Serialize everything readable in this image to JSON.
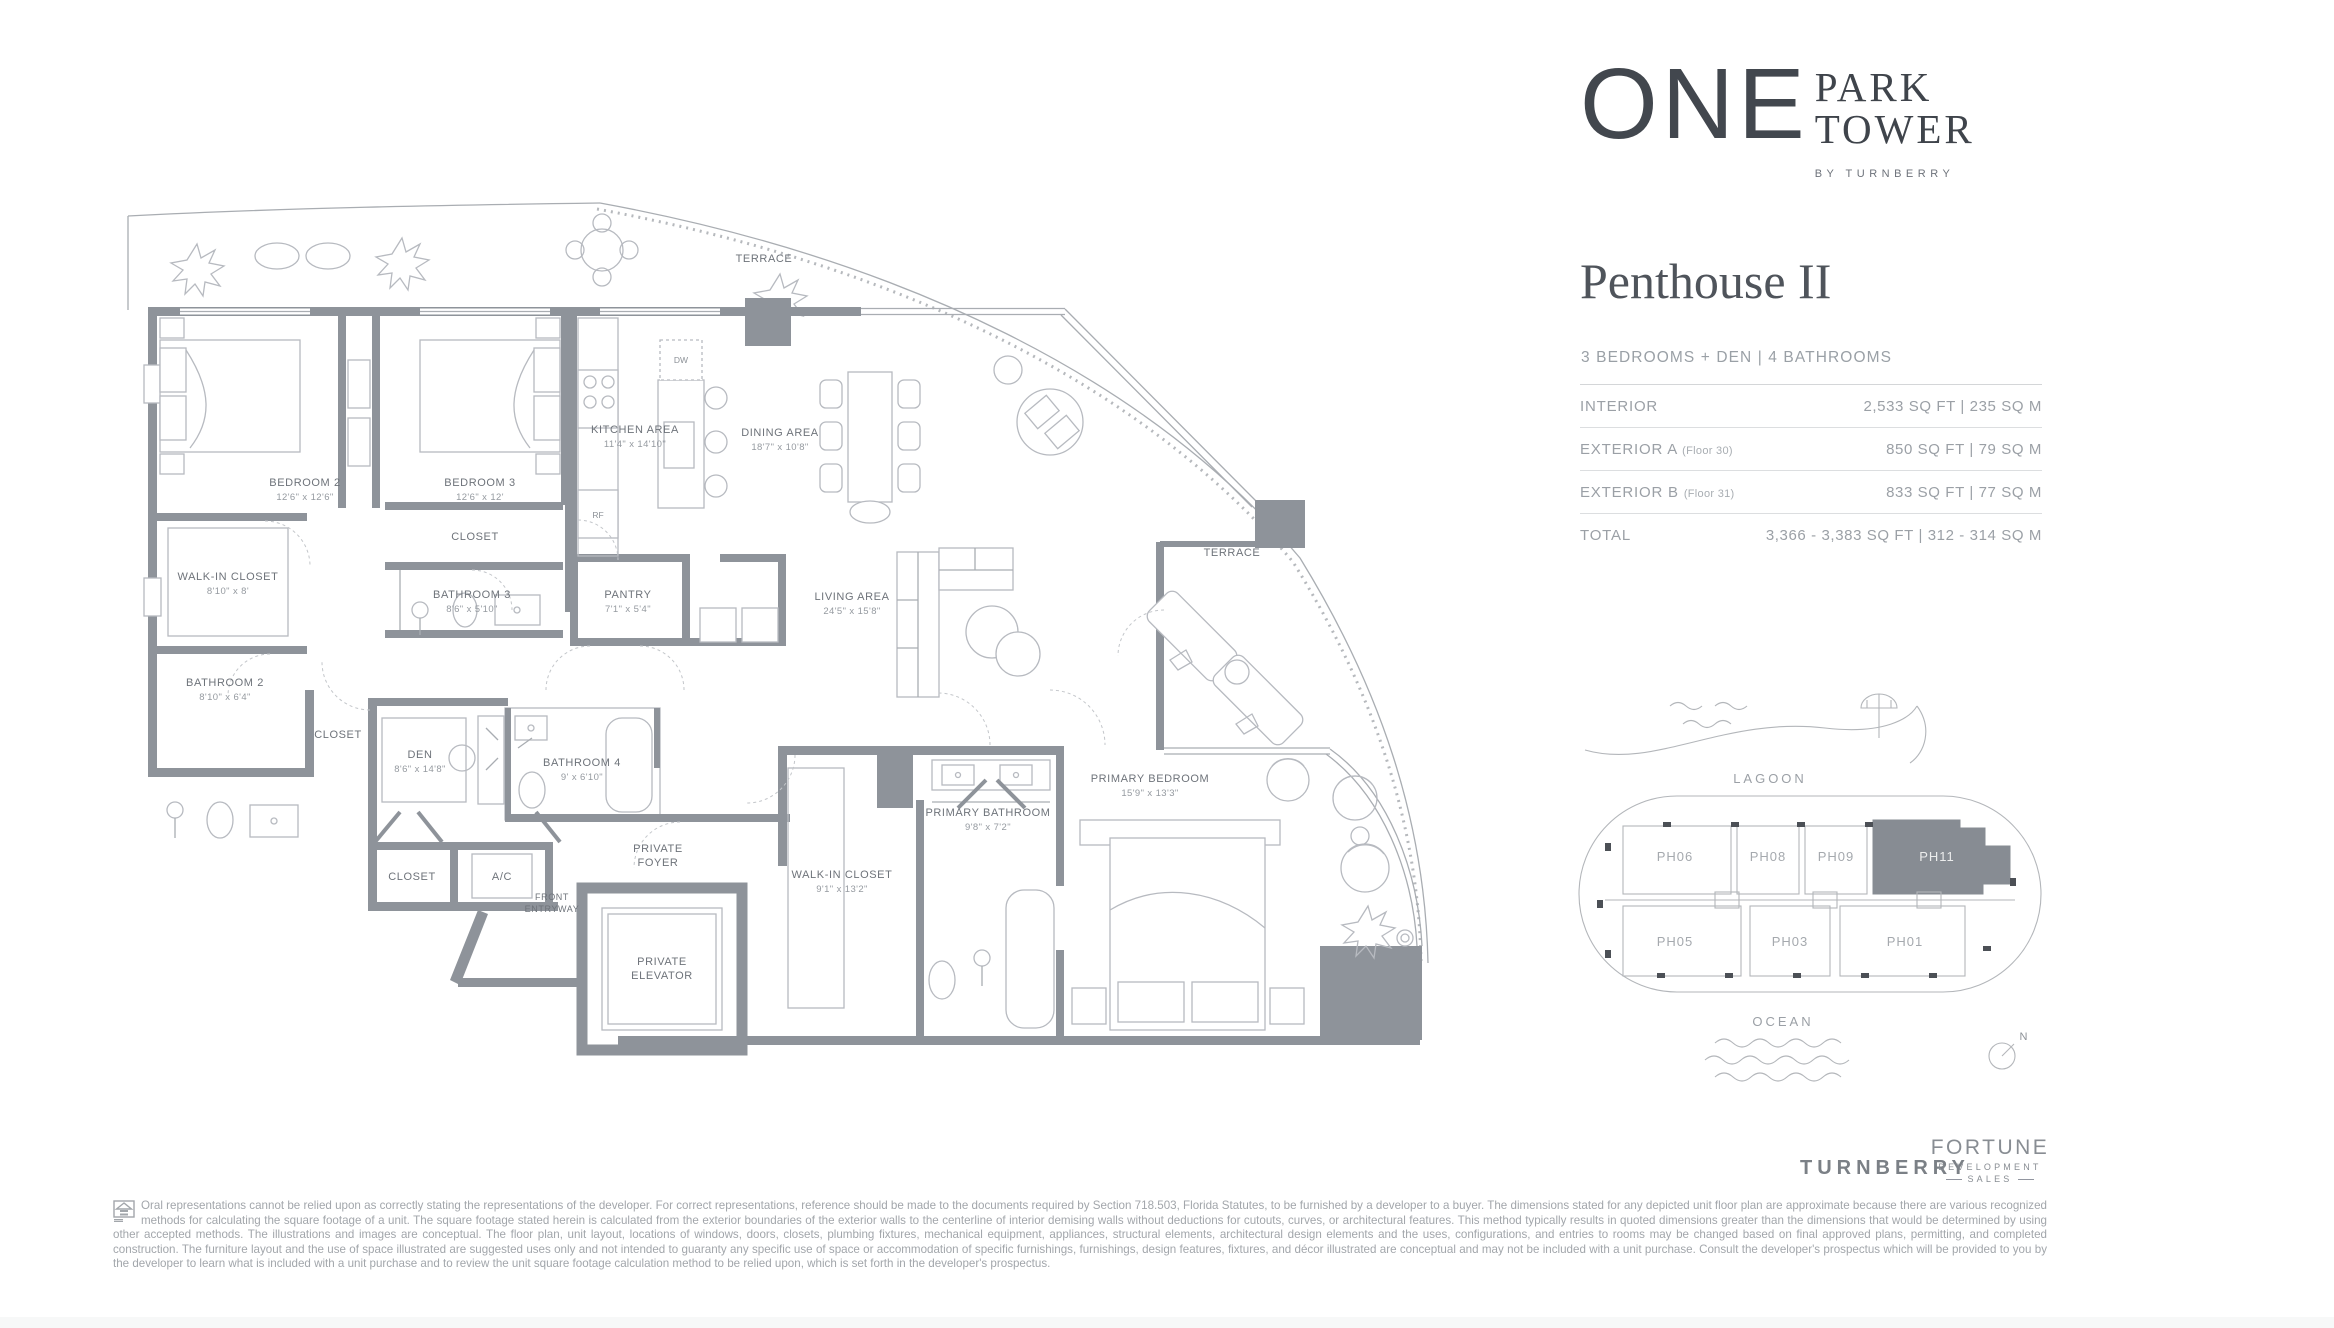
{
  "logo": {
    "one": "ONE",
    "park": "PARK",
    "tower": "TOWER",
    "byline": "BY TURNBERRY"
  },
  "unit": {
    "title": "Penthouse II",
    "subtitle": "3 BEDROOMS + DEN | 4 BATHROOMS",
    "specs": [
      {
        "label": "INTERIOR",
        "note": "",
        "value": "2,533 SQ FT  |  235 SQ M"
      },
      {
        "label": "EXTERIOR A",
        "note": "(Floor 30)",
        "value": "850 SQ FT  |  79 SQ M"
      },
      {
        "label": "EXTERIOR B",
        "note": "(Floor 31)",
        "value": "833 SQ FT  |  77 SQ M"
      },
      {
        "label": "TOTAL",
        "note": "",
        "value": "3,366 - 3,383 SQ FT  |  312 - 314 SQ M"
      }
    ]
  },
  "keyplan": {
    "lagoon": "LAGOON",
    "ocean": "OCEAN",
    "north": "N",
    "units": [
      "PH06",
      "PH08",
      "PH09",
      "PH11",
      "PH05",
      "PH03",
      "PH01"
    ],
    "highlighted": "PH11",
    "highlight_color": "#878c93"
  },
  "brands": {
    "turnberry": "TURNBERRY",
    "fortune_line1": "FORTUNE",
    "fortune_line2": "DEVELOPMENT",
    "fortune_line3": "SALES"
  },
  "disclaimer": {
    "text": "Oral representations cannot be relied upon as correctly stating the representations of the developer. For correct representations, reference should be made to the documents required by Section 718.503, Florida Statutes, to be furnished by a developer to a buyer. The dimensions stated for any depicted unit floor plan are approximate because there are various recognized methods for calculating the square footage of a unit. The square footage stated herein is calculated from the exterior boundaries of the exterior walls to the centerline of interior demising walls without deductions for cutouts, curves, or architectural features. This method typically results in quoted dimensions greater than the dimensions that would be determined by using other accepted methods. The illustrations and images are conceptual. The floor plan, unit layout, locations of windows, doors, closets, plumbing fixtures, mechanical equipment, appliances, structural elements, architectural design elements and the uses, configurations, and entries to rooms may be changed based on final approved plans, permitting, and completed construction. The furniture layout and the use of space illustrated are suggested uses only and not intended to guaranty any specific use of space or accommodation of specific furnishings, furnishings, design features, fixtures, and décor illustrated are conceptual and may not be included with a unit purchase. Consult the developer's prospectus which will be provided to you by the developer to learn what is included with a unit purchase and to review the unit square footage calculation method to be relied upon, which is set forth in the developer's prospectus."
  },
  "fp": {
    "terrace_top": "TERRACE",
    "terrace_right": "TERRACE",
    "bedroom2": "BEDROOM 2",
    "bedroom2_d": "12'6\" x 12'6\"",
    "bedroom3": "BEDROOM 3",
    "bedroom3_d": "12'6\" x 12'",
    "walkin2": "WALK-IN CLOSET",
    "walkin2_d": "8'10\" x 8'",
    "bath2": "BATHROOM 2",
    "bath2_d": "8'10\" x 6'4\"",
    "closet_hall": "CLOSET",
    "closet3": "CLOSET",
    "bath3": "BATHROOM 3",
    "bath3_d": "8'6\" x 5'10\"",
    "kitchen": "KITCHEN AREA",
    "kitchen_d": "11'4\" x 14'10\"",
    "dining": "DINING AREA",
    "dining_d": "18'7\" x 10'8\"",
    "pantry": "PANTRY",
    "pantry_d": "7'1\" x 5'4\"",
    "living": "LIVING AREA",
    "living_d": "24'5\" x 15'8\"",
    "den": "DEN",
    "den_d": "8'6\" x 14'8\"",
    "bath4": "BATHROOM 4",
    "bath4_d": "9' x 6'10\"",
    "closet_den": "CLOSET",
    "ac": "A/C",
    "front1": "FRONT",
    "front2": "ENTRYWAY",
    "foyer1": "PRIVATE",
    "foyer2": "FOYER",
    "elev1": "PRIVATE",
    "elev2": "ELEVATOR",
    "walkin1": "WALK-IN CLOSET",
    "walkin1_d": "9'1\" x 13'2\"",
    "pbath": "PRIMARY BATHROOM",
    "pbath_d": "9'8\" x 7'2\"",
    "pbed": "PRIMARY BEDROOM",
    "pbed_d": "15'9\" x 13'3\"",
    "dw": "DW",
    "rf": "RF",
    "d": "D",
    "w": "W"
  }
}
